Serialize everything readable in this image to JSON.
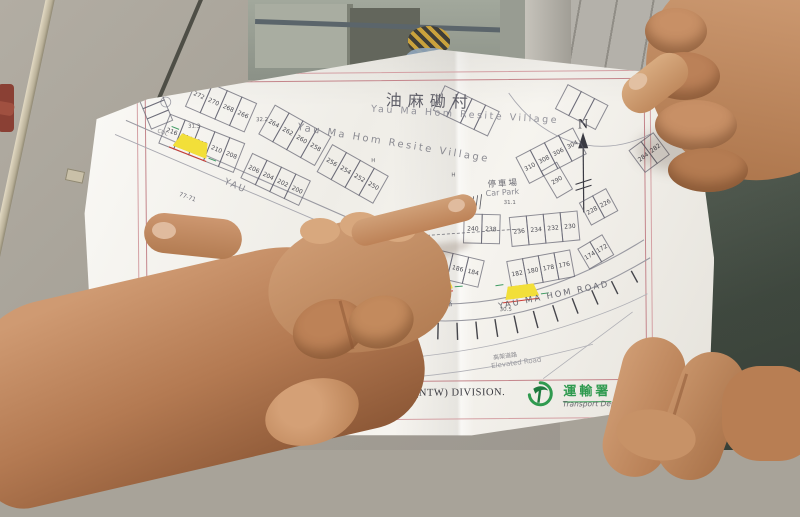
{
  "map": {
    "title_zh": "油麻磡村",
    "title_en": "Yau Ma Hom Resite Village",
    "village_mid": "Yau Ma Hom Resite Village",
    "north": "N",
    "car_park_zh": "停車場",
    "car_park_en": "Car Park",
    "road_left": "YAU",
    "road_main_zh": "油麻磡路",
    "road_main_en": "YAU MA HOM ROAD",
    "elevated_zh": "高架道路",
    "elevated_en": "Elevated Road",
    "scale": "SCALE 1:500",
    "division": "TRAFFIC ENGINEERING (NTW) DIVISION.",
    "dept_zh": "運輸署",
    "dept_en": "Transport Department",
    "building_range": "77-71",
    "cul": "CUL",
    "colors": {
      "map_border": "#c4858b",
      "highlight_yellow": "#f2df39",
      "annotation_red": "#cc3b35",
      "annotation_green": "#3f9b63",
      "dept_green": "#2f9a4f",
      "paper": "#f3f1ec"
    },
    "strips": [
      {
        "x": 128,
        "y": 30,
        "a": 24,
        "cw": 15,
        "ch": 30,
        "nums": [
          "272",
          "270",
          "268",
          "266"
        ]
      },
      {
        "x": 100,
        "y": 66,
        "a": 22,
        "cw": 15,
        "ch": 30,
        "nums": [
          "216",
          "214",
          "212",
          "210",
          "208"
        ]
      },
      {
        "x": 205,
        "y": 58,
        "a": 30,
        "cw": 15,
        "ch": 32,
        "nums": [
          "264",
          "262",
          "260",
          "258"
        ]
      },
      {
        "x": 182,
        "y": 106,
        "a": 26,
        "cw": 15,
        "ch": 26,
        "nums": [
          "206",
          "204",
          "202",
          "200"
        ]
      },
      {
        "x": 262,
        "y": 98,
        "a": 30,
        "cw": 15,
        "ch": 30,
        "nums": [
          "256",
          "254",
          "252",
          "250"
        ]
      },
      {
        "x": 375,
        "y": 40,
        "a": 26,
        "cw": 14,
        "ch": 26,
        "nums": [
          "",
          "",
          "",
          ""
        ]
      },
      {
        "x": 498,
        "y": 40,
        "a": 28,
        "cw": 14,
        "ch": 26,
        "nums": [
          "",
          "",
          ""
        ]
      },
      {
        "x": 445,
        "y": 112,
        "a": -27,
        "cw": 15,
        "ch": 28,
        "nums": [
          "310",
          "308",
          "306",
          "304"
        ]
      },
      {
        "x": 470,
        "y": 126,
        "a": -30,
        "cw": 17,
        "ch": 30,
        "nums": [
          "290"
        ]
      },
      {
        "x": 558,
        "y": 106,
        "a": -36,
        "cw": 14,
        "ch": 26,
        "nums": [
          "284",
          "282"
        ]
      },
      {
        "x": 393,
        "y": 168,
        "a": 2,
        "cw": 17,
        "ch": 28,
        "nums": [
          "240",
          "238"
        ]
      },
      {
        "x": 438,
        "y": 172,
        "a": -5,
        "cw": 16,
        "ch": 28,
        "nums": [
          "236",
          "234",
          "232",
          "230"
        ]
      },
      {
        "x": 508,
        "y": 158,
        "a": -28,
        "cw": 14,
        "ch": 24,
        "nums": [
          "228",
          "226"
        ]
      },
      {
        "x": 335,
        "y": 196,
        "a": 14,
        "cw": 15,
        "ch": 26,
        "nums": [
          "192",
          "190",
          "188",
          "186",
          "184"
        ]
      },
      {
        "x": 435,
        "y": 216,
        "a": -10,
        "cw": 15,
        "ch": 26,
        "nums": [
          "182",
          "180",
          "178",
          "176"
        ]
      },
      {
        "x": 506,
        "y": 204,
        "a": -30,
        "cw": 13,
        "ch": 22,
        "nums": [
          "174",
          "172"
        ]
      },
      {
        "x": 90,
        "y": 42,
        "a": 68,
        "cw": 10,
        "ch": 22,
        "nums": [
          "",
          "",
          ""
        ]
      }
    ],
    "spots": [
      {
        "t": "32.2",
        "x": 185,
        "y": 70
      },
      {
        "t": "31.3",
        "x": 117,
        "y": 76
      },
      {
        "t": "31.1",
        "x": 432,
        "y": 155
      },
      {
        "t": "30.5",
        "x": 427,
        "y": 262
      },
      {
        "t": "H",
        "x": 380,
        "y": 127
      },
      {
        "t": "H",
        "x": 300,
        "y": 112
      }
    ],
    "humps": [
      {
        "x": 103,
        "y": 90,
        "w": 36,
        "h": 15,
        "a": 22
      },
      {
        "x": 348,
        "y": 231,
        "w": 32,
        "h": 13,
        "a": -4
      },
      {
        "x": 432,
        "y": 240,
        "w": 34,
        "h": 13,
        "a": -7
      }
    ]
  }
}
